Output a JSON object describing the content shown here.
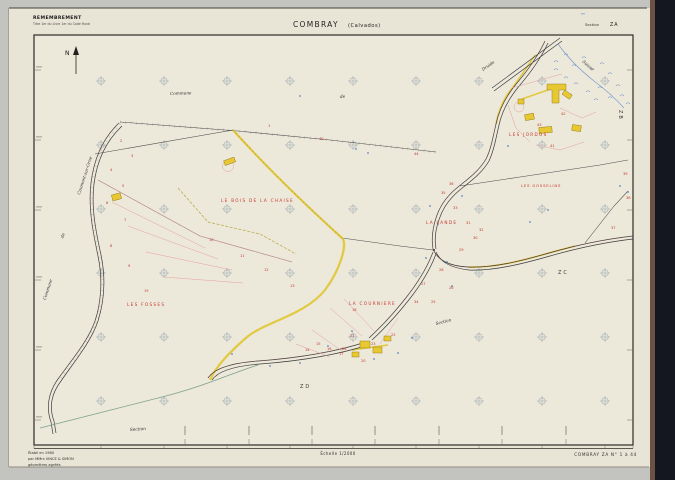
{
  "header": {
    "doc_type": "REMEMBREMENT",
    "doc_type_sub": "Titre 1er du Livre 1er du Code Rural",
    "title_main": "COMBRAY",
    "title_sub": "(Calvados)",
    "section_label": "Section",
    "section_value": "ZA"
  },
  "footer": {
    "credit_line1": "Établi en 1980",
    "credit_line2": "par MMrs VINCE & SIMON",
    "credit_line3": "géomètres agréés",
    "scale": "Échelle 1/2000",
    "sheet_ref": "COMBRAY ZA N° 1 à 44"
  },
  "map": {
    "north_label": "N",
    "lieux_dits": {
      "jordos": "LES JORDOS",
      "gosselins": "LES GOSSELINS",
      "bois_chaise": "LE BOIS DE LA CHAISE",
      "lande": "LA LANDE",
      "fosses": "LES FOSSES",
      "courniere": "LA COURNIERE"
    },
    "labels": {
      "commune_top": "Commune",
      "de_top": "de",
      "commune_left": "Commune",
      "de_left": "de",
      "road_caumont": "Caumont-sur-Orne",
      "stream_druide": "Druide",
      "stream_suisse": "Suisse",
      "section_word_mid": "Section",
      "section_word_bottom": "Section",
      "adj_zb": "ZB",
      "adj_zc": "ZC",
      "adj_zd": "ZD"
    },
    "parcel_numbers": [
      {
        "n": "1",
        "x": 268,
        "y": 127
      },
      {
        "n": "2",
        "x": 120,
        "y": 142
      },
      {
        "n": "3",
        "x": 131,
        "y": 157
      },
      {
        "n": "4",
        "x": 110,
        "y": 171
      },
      {
        "n": "5",
        "x": 122,
        "y": 187
      },
      {
        "n": "6",
        "x": 106,
        "y": 204
      },
      {
        "n": "7",
        "x": 124,
        "y": 221
      },
      {
        "n": "8",
        "x": 110,
        "y": 247
      },
      {
        "n": "9",
        "x": 128,
        "y": 267
      },
      {
        "n": "10",
        "x": 209,
        "y": 241
      },
      {
        "n": "11",
        "x": 240,
        "y": 257
      },
      {
        "n": "12",
        "x": 264,
        "y": 271
      },
      {
        "n": "13",
        "x": 290,
        "y": 287
      },
      {
        "n": "14",
        "x": 305,
        "y": 351
      },
      {
        "n": "15",
        "x": 316,
        "y": 345
      },
      {
        "n": "16",
        "x": 327,
        "y": 350
      },
      {
        "n": "17",
        "x": 339,
        "y": 355
      },
      {
        "n": "18",
        "x": 352,
        "y": 311
      },
      {
        "n": "19",
        "x": 144,
        "y": 292
      },
      {
        "n": "20",
        "x": 361,
        "y": 362
      },
      {
        "n": "21",
        "x": 350,
        "y": 337
      },
      {
        "n": "22",
        "x": 391,
        "y": 336
      },
      {
        "n": "23",
        "x": 371,
        "y": 345
      },
      {
        "n": "24",
        "x": 342,
        "y": 350
      },
      {
        "n": "25",
        "x": 431,
        "y": 303
      },
      {
        "n": "26",
        "x": 449,
        "y": 289
      },
      {
        "n": "27",
        "x": 421,
        "y": 285
      },
      {
        "n": "28",
        "x": 439,
        "y": 271
      },
      {
        "n": "29",
        "x": 459,
        "y": 251
      },
      {
        "n": "30",
        "x": 473,
        "y": 239
      },
      {
        "n": "31",
        "x": 466,
        "y": 224
      },
      {
        "n": "32",
        "x": 479,
        "y": 231
      },
      {
        "n": "33",
        "x": 453,
        "y": 209
      },
      {
        "n": "34",
        "x": 414,
        "y": 303
      },
      {
        "n": "35",
        "x": 441,
        "y": 194
      },
      {
        "n": "36",
        "x": 449,
        "y": 185
      },
      {
        "n": "37",
        "x": 611,
        "y": 229
      },
      {
        "n": "38",
        "x": 626,
        "y": 199
      },
      {
        "n": "39",
        "x": 623,
        "y": 175
      },
      {
        "n": "40",
        "x": 319,
        "y": 140
      },
      {
        "n": "41",
        "x": 550,
        "y": 147
      },
      {
        "n": "42",
        "x": 561,
        "y": 115
      },
      {
        "n": "43",
        "x": 537,
        "y": 126
      },
      {
        "n": "44",
        "x": 414,
        "y": 155
      }
    ],
    "colors": {
      "paper": "#e9e5d6",
      "road_yellow": "#e2c738",
      "parcel_red": "#c5372e",
      "water_blue": "#5d84c8",
      "line_black": "#3c3c3c",
      "pink": "#e6a0a0"
    }
  }
}
